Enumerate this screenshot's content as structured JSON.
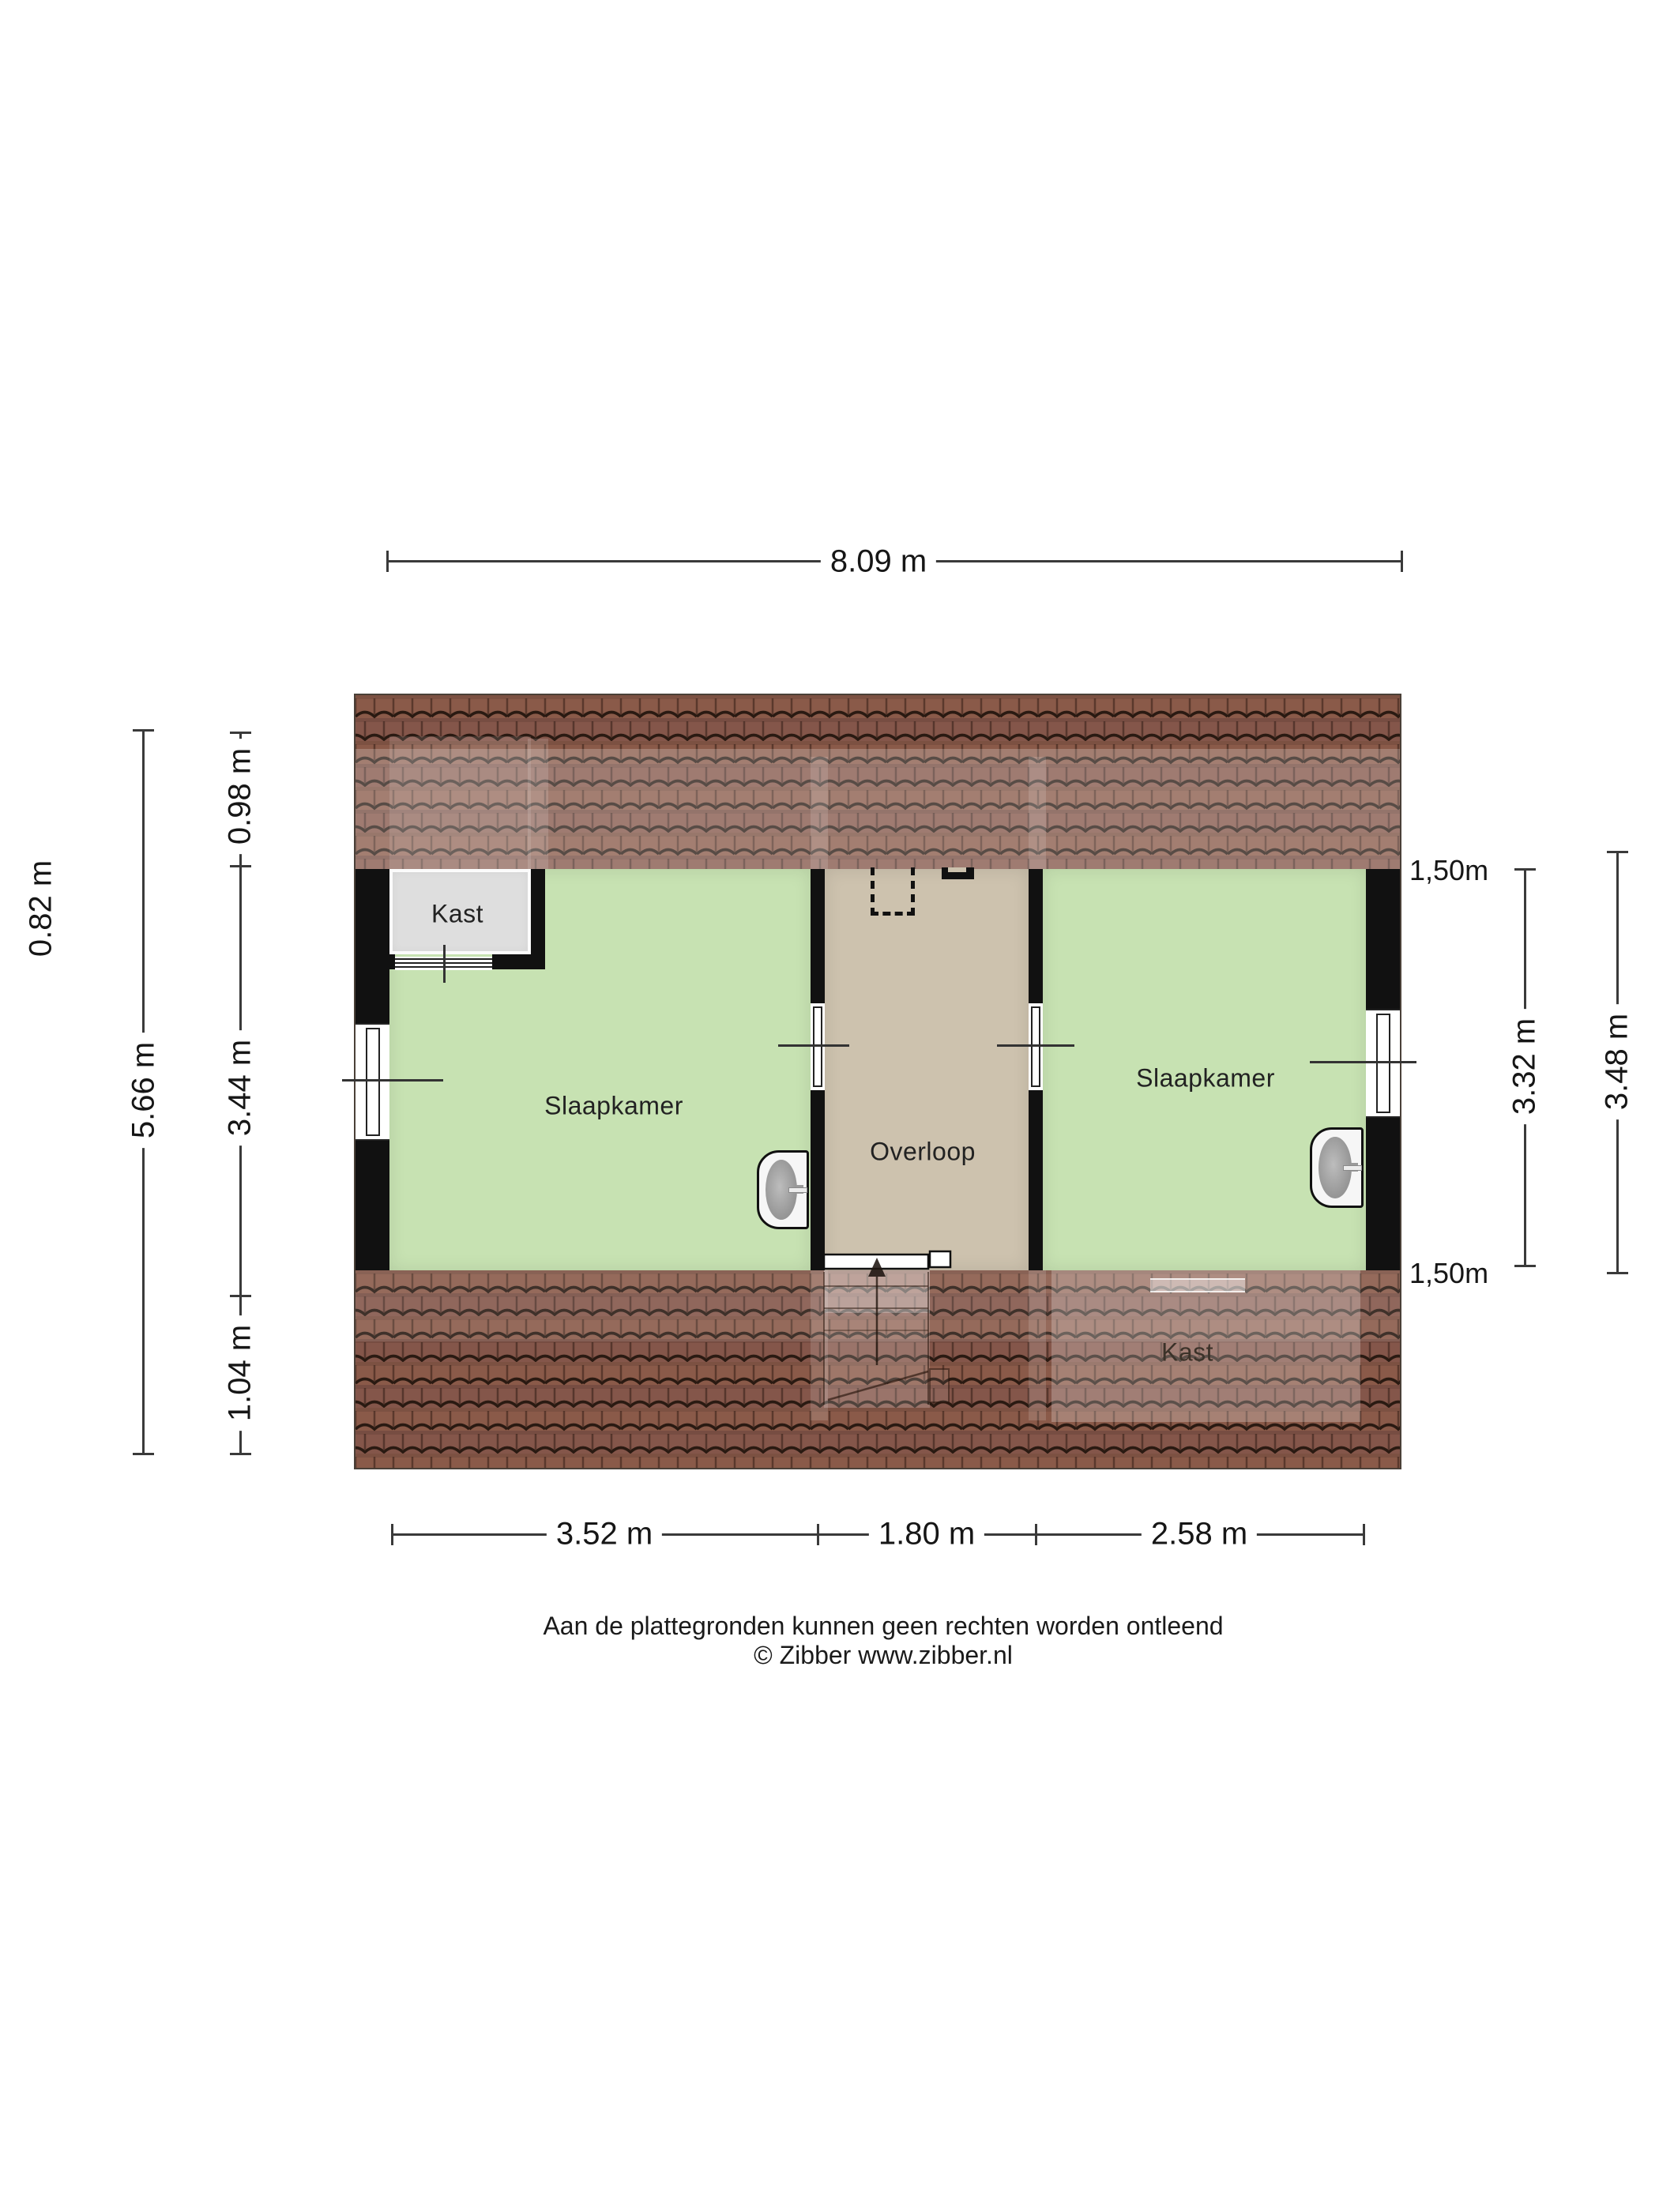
{
  "floorplan": {
    "rooms": {
      "kast_top_left": "Kast",
      "slaapkamer_left": "Slaapkamer",
      "overloop": "Overloop",
      "slaapkamer_right": "Slaapkamer",
      "kast_bottom_right": "Kast"
    },
    "dimensions": {
      "top_width": "8.09 m",
      "bottom_segments": [
        "3.52 m",
        "1.80 m",
        "2.58 m"
      ],
      "left_outer": "0.82 m",
      "left_total_height": "5.66 m",
      "left_segments": [
        "0.98 m",
        "3.44 m",
        "1.04 m"
      ],
      "right_knee_wall_top": "1,50m",
      "right_knee_wall_bottom": "1,50m",
      "right_room_height": "3.32 m",
      "right_total_height": "3.48 m"
    },
    "footer": {
      "disclaimer": "Aan de plattegronden kunnen geen rechten worden ontleend",
      "copyright": "© Zibber www.zibber.nl"
    },
    "colors": {
      "room_green": "#c7e2b2",
      "landing_tan": "#cdc2ae",
      "closet_gray": "#dedede",
      "wall_black": "#111111",
      "roof_brown": "#8a5a49",
      "roof_brown_alt": "#84564a",
      "roof_edge": "#2a1a12",
      "text_color": "#1a1a1a"
    }
  }
}
